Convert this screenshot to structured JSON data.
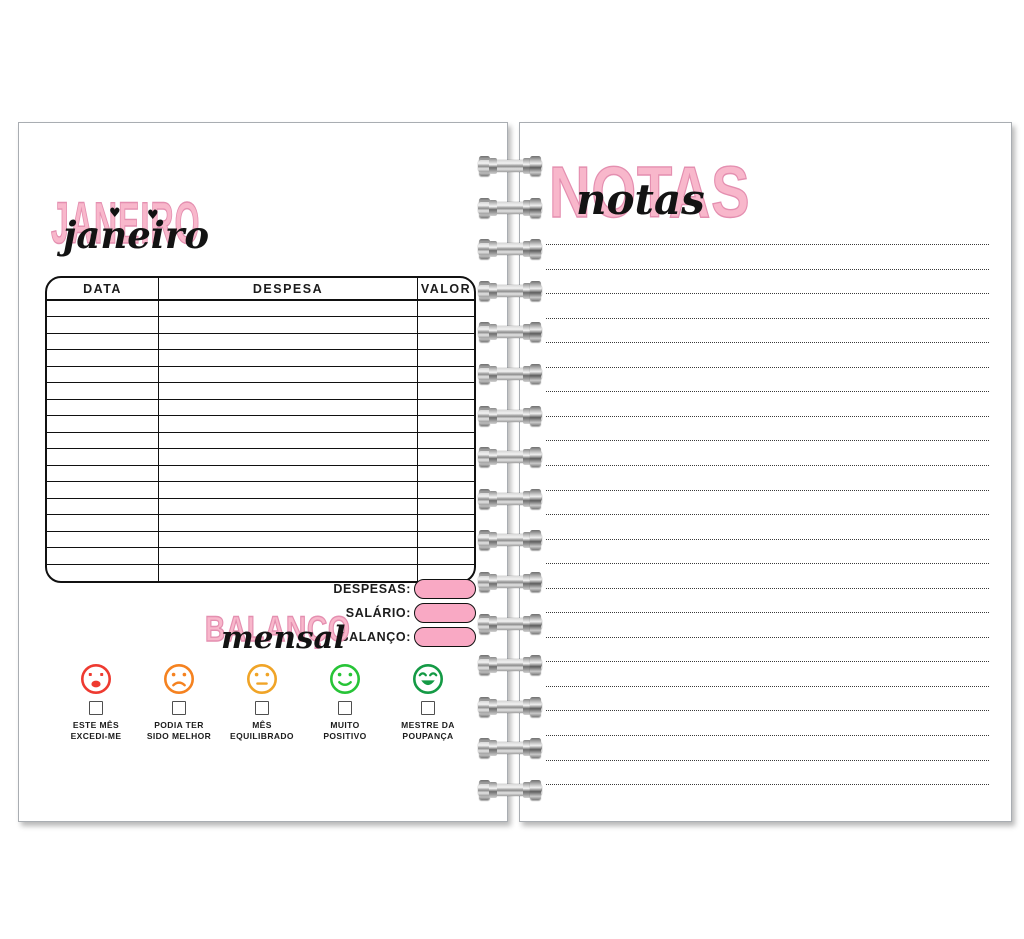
{
  "left_page": {
    "month_title": {
      "outline": "JANEIRO",
      "script": "janeiro"
    },
    "table": {
      "headers": [
        "DATA",
        "DESPESA",
        "VALOR"
      ],
      "empty_rows": 17
    },
    "balance": {
      "title_outline": "BALANÇO",
      "title_script": "mensal",
      "fields": [
        {
          "label": "DESPESAS:"
        },
        {
          "label": "SALÁRIO:"
        },
        {
          "label": "BALANÇO:"
        }
      ]
    },
    "moods": [
      {
        "face": "open-frown",
        "color": "#EE3A30",
        "label_line1": "ESTE MÊS",
        "label_line2": "EXCEDI-ME"
      },
      {
        "face": "frown",
        "color": "#F58220",
        "label_line1": "PODIA TER",
        "label_line2": "SIDO MELHOR"
      },
      {
        "face": "neutral",
        "color": "#F0A427",
        "label_line1": "MÊS",
        "label_line2": "EQUILIBRADO"
      },
      {
        "face": "smile",
        "color": "#27C437",
        "label_line1": "MUITO",
        "label_line2": "POSITIVO"
      },
      {
        "face": "big-smile",
        "color": "#149A45",
        "label_line1": "MESTRE DA",
        "label_line2": "POUPANÇA"
      }
    ]
  },
  "right_page": {
    "title": {
      "outline": "NOTAS",
      "script": "notas"
    },
    "note_lines": 23
  },
  "binding": {
    "coils": 16
  },
  "colors": {
    "title_pink": "#F8B7CB",
    "title_pink_outline": "#E48FB0",
    "pill_pink": "#F9A9C4",
    "ink": "#1C1C1C"
  }
}
